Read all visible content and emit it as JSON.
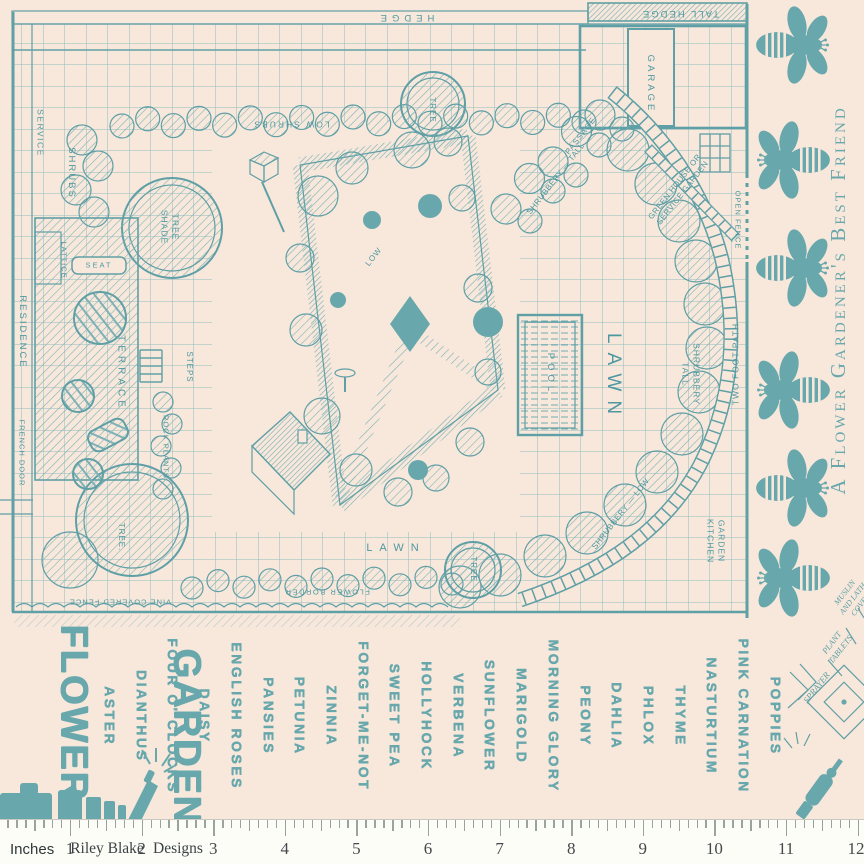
{
  "fabric": {
    "colors": {
      "background": "#f8e8db",
      "ink": "#5f9fa6",
      "ink_light": "#7db1b5",
      "grid": "#90bcc0",
      "solid": "#68a8ad",
      "label": "#4f98a1",
      "tick": "#9ba39f",
      "ruler_bg": "#fdfdf8",
      "ruler_text": "#44494b"
    },
    "title": {
      "line1": "FLOWER",
      "line2": "GARDEN"
    },
    "side_text": "A Flower Gardener's Best Friend",
    "bees": {
      "count": 6
    },
    "plan": {
      "labels": [
        {
          "text": "HEDGE",
          "x": 405,
          "y": 17,
          "rot": 180,
          "fs": 9.5,
          "ls": 5
        },
        {
          "text": "TALL HEDGE",
          "x": 680,
          "y": 13,
          "rot": 180,
          "fs": 9.5,
          "ls": 2
        },
        {
          "text": "LOW SHRUBS",
          "x": 291,
          "y": 124,
          "rot": 180,
          "fs": 8.5,
          "ls": 2
        },
        {
          "text": "TREE",
          "x": 432,
          "y": 110,
          "rot": 90,
          "fs": 8,
          "ls": 1
        },
        {
          "text": "GARAGE",
          "x": 650,
          "y": 84,
          "rot": 90,
          "fs": 9.5,
          "ls": 3
        },
        {
          "text": "SERVICE",
          "x": 40,
          "y": 133,
          "rot": 90,
          "fs": 8.5,
          "ls": 1.5
        },
        {
          "text": "SHRUBS",
          "x": 71,
          "y": 173,
          "rot": 90,
          "fs": 9.5,
          "ls": 2
        },
        {
          "lines": [
            "SHADE",
            "TREE"
          ],
          "x": 170,
          "y": 227,
          "rot": 90,
          "fs": 8.5,
          "ls": 1
        },
        {
          "text": "LATTICE",
          "x": 64,
          "y": 260,
          "rot": 90,
          "fs": 7.5,
          "ls": 1
        },
        {
          "text": "SEAT",
          "x": 99,
          "y": 265,
          "rot": 0,
          "fs": 7.5,
          "ls": 2
        },
        {
          "text": "PASSAGE",
          "x": 581,
          "y": 136,
          "rot": -52,
          "fs": 8,
          "ls": 1
        },
        {
          "text": "SHRUBBERY — TALL",
          "x": 556,
          "y": 179,
          "rot": -52,
          "fs": 8,
          "ls": 0.5
        },
        {
          "lines": [
            "GREEN HOUSE OR",
            "SERVICE GARDEN"
          ],
          "x": 679,
          "y": 190,
          "rot": -52,
          "fs": 8,
          "ls": 0.5
        },
        {
          "text": "OPEN FENCE",
          "x": 738,
          "y": 220,
          "rot": 90,
          "fs": 7.5,
          "ls": 1
        },
        {
          "text": "RESIDENCE",
          "x": 22,
          "y": 332,
          "rot": 90,
          "fs": 9.5,
          "ls": 2
        },
        {
          "text": "FRENCH DOOR",
          "x": 22,
          "y": 453,
          "rot": 90,
          "fs": 7.5,
          "ls": 1
        },
        {
          "text": "TERRACE",
          "x": 120,
          "y": 373,
          "rot": 90,
          "fs": 10,
          "ls": 4
        },
        {
          "text": "STEPS",
          "x": 189,
          "y": 367,
          "rot": 90,
          "fs": 8,
          "ls": 1
        },
        {
          "text": "ROCK PLANTS",
          "x": 166,
          "y": 447,
          "rot": 90,
          "fs": 7.5,
          "ls": 1
        },
        {
          "text": "POOL",
          "x": 550,
          "y": 374,
          "rot": 90,
          "fs": 9.5,
          "ls": 4
        },
        {
          "text": "LAWN",
          "x": 613,
          "y": 378,
          "rot": 90,
          "fs": 19,
          "ls": 9
        },
        {
          "lines": [
            "TALL",
            "SHRUBBERY"
          ],
          "x": 691,
          "y": 374,
          "rot": 90,
          "fs": 8.5,
          "ls": 1
        },
        {
          "text": "TWO FOOT PATH",
          "x": 736,
          "y": 364,
          "rot": -90,
          "fs": 8.5,
          "ls": 1
        },
        {
          "text": "SHRUBBERY — LOW",
          "x": 621,
          "y": 514,
          "rot": -52,
          "fs": 8,
          "ls": 0.5
        },
        {
          "text": "LOW",
          "x": 374,
          "y": 257,
          "rot": -52,
          "fs": 8,
          "ls": 1
        },
        {
          "lines": [
            "KITCHEN",
            "GARDEN"
          ],
          "x": 716,
          "y": 541,
          "rot": 90,
          "fs": 8.5,
          "ls": 1
        },
        {
          "text": "TREE.",
          "x": 121,
          "y": 537,
          "rot": 90,
          "fs": 8,
          "ls": 1
        },
        {
          "text": "TREE",
          "x": 473,
          "y": 569,
          "rot": 90,
          "fs": 8,
          "ls": 1
        },
        {
          "text": "LAWN",
          "x": 396,
          "y": 549,
          "rot": 0,
          "fs": 11,
          "ls": 7
        },
        {
          "text": "FLOWER BORDER",
          "x": 327,
          "y": 592,
          "rot": 180,
          "fs": 7.5,
          "ls": 1.5
        },
        {
          "text": "VINE COVERED FENCE",
          "x": 120,
          "y": 602,
          "rot": 180,
          "fs": 7.5,
          "ls": 1
        }
      ]
    },
    "annotations": [
      {
        "text": "SPRAYER",
        "x": 817,
        "y": 688,
        "rot": -52,
        "fs": 9,
        "hand": true
      },
      {
        "lines": [
          "PLANT",
          "TABLETS"
        ],
        "x": 836,
        "y": 646,
        "rot": -52,
        "fs": 8.5,
        "hand": true
      },
      {
        "lines": [
          "MUSLIN",
          "AND LATH",
          "COVER"
        ],
        "x": 853,
        "y": 599,
        "rot": -52,
        "fs": 8,
        "hand": true
      }
    ],
    "flower_names": [
      "ASTER",
      "DIANTHUS",
      "FOUR O' CLOCKS",
      "DAISY",
      "ENGLISH ROSES",
      "PANSIES",
      "PETUNIA",
      "ZINNIA",
      "FORGET-ME-NOT",
      "SWEET PEA",
      "HOLLYHOCK",
      "VERBENA",
      "SUNFLOWER",
      "MARIGOLD",
      "MORNING GLORY",
      "PEONY",
      "DAHLIA",
      "PHLOX",
      "THYME",
      "NASTURTIUM",
      "PINK CARNATION",
      "POPPIES"
    ],
    "ruler": {
      "unit_label": "Inches",
      "numbers": [
        1,
        2,
        3,
        4,
        5,
        6,
        7,
        8,
        9,
        10,
        11,
        12
      ],
      "brand_first": "Riley Blake",
      "brand_second": "Designs"
    }
  }
}
